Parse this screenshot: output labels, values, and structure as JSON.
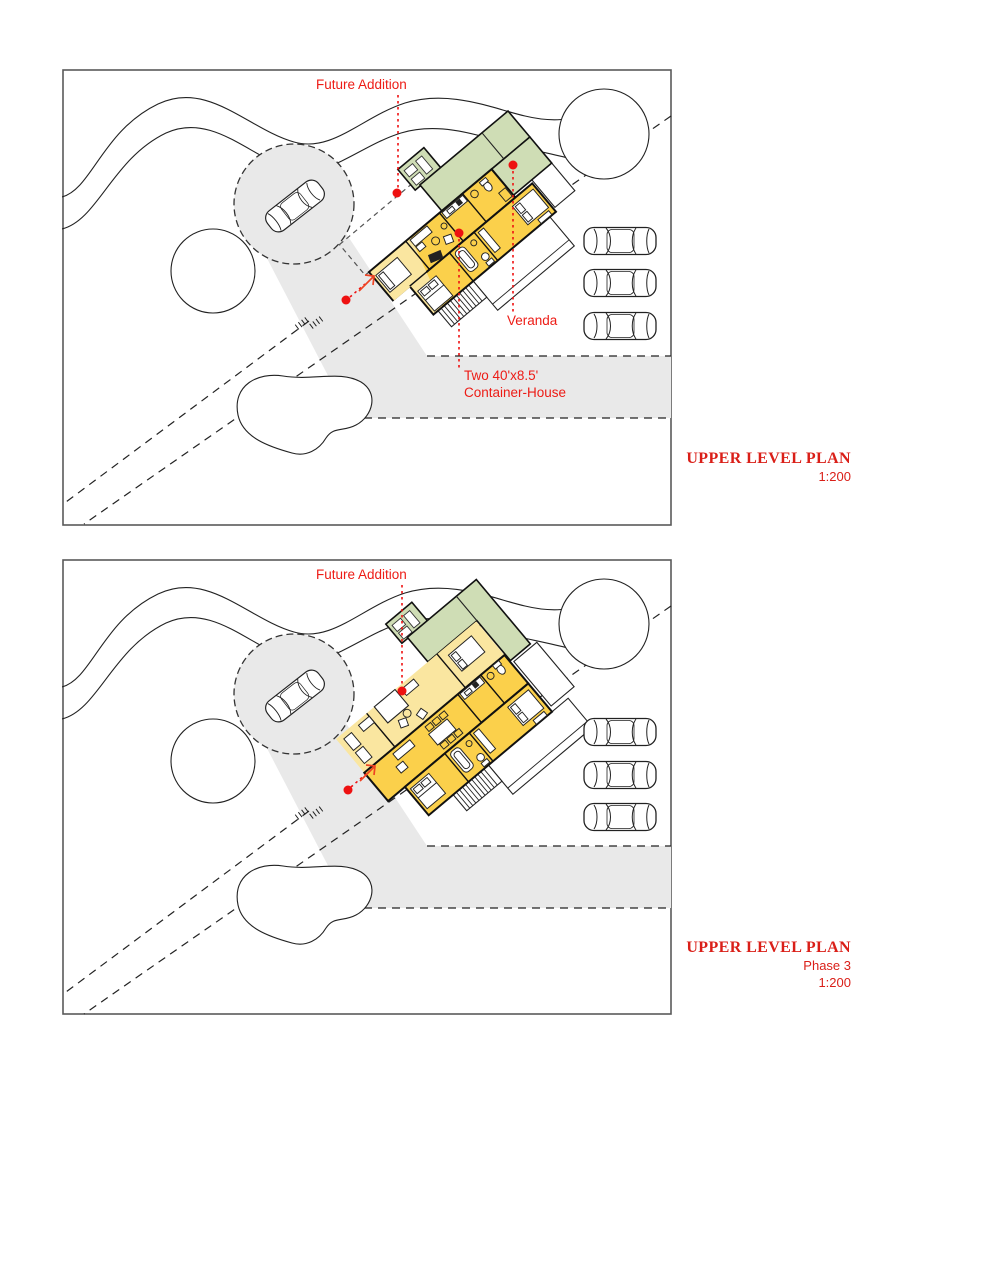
{
  "colors": {
    "container_yellow": "#fbd04b",
    "addition_yellow": "#fae6a0",
    "veranda_green": "#cfddb5",
    "driveway_gray": "#e9e9e9",
    "annotation_red": "#ed1c16",
    "dot_red": "#ee1111",
    "line_black": "#222222"
  },
  "panel_top": {
    "labels": {
      "future_addition": "Future Addition",
      "veranda": "Veranda",
      "container_line1": "Two 40'x8.5'",
      "container_line2": "Container-House"
    },
    "title": {
      "heading": "UPPER LEVEL PLAN",
      "scale": "1:200"
    }
  },
  "panel_bottom": {
    "labels": {
      "future_addition": "Future Addition"
    },
    "title": {
      "heading": "UPPER LEVEL PLAN",
      "phase": "Phase 3",
      "scale": "1:200"
    }
  }
}
